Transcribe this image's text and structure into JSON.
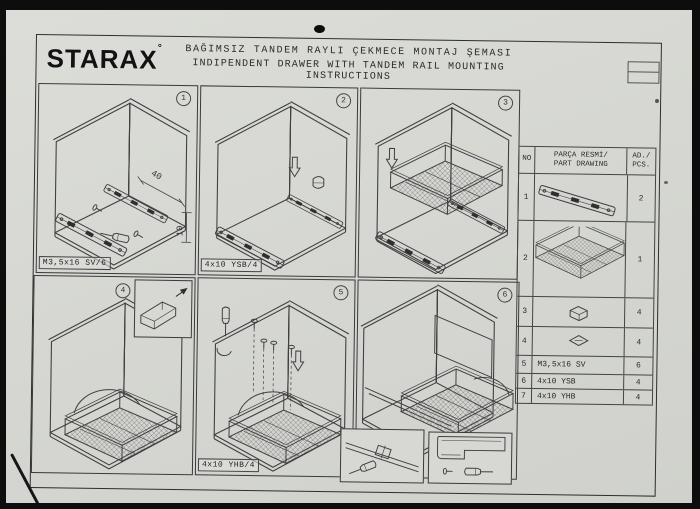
{
  "header": {
    "logo": "STARAX",
    "logo_mark": "°",
    "title_line1": "BAĞIMSIZ TANDEM RAYLI ÇEKMECE MONTAJ ŞEMASI",
    "title_line2": "INDIPENDENT DRAWER WITH TANDEM RAIL MOUNTING INSTRUCTIONS"
  },
  "panels": [
    {
      "number": "1",
      "label": "M3,5x16 SV/6",
      "dim_a": "40",
      "dim_b": "10"
    },
    {
      "number": "2",
      "label": "4x10 YSB/4"
    },
    {
      "number": "3"
    },
    {
      "number": "4"
    },
    {
      "number": "5",
      "label": "4x10 YHB/4"
    },
    {
      "number": "6"
    }
  ],
  "table": {
    "header_no": "NO",
    "header_part_1": "PARÇA RESMİ/",
    "header_part_2": "PART DRAWING",
    "header_qty_1": "AD./",
    "header_qty_2": "PCS.",
    "rows": [
      {
        "no": "1",
        "part": "tandem-rail-drawing",
        "qty": "2"
      },
      {
        "no": "2",
        "part": "wire-basket-drawing",
        "qty": "1"
      },
      {
        "no": "3",
        "part": "plastic-clip-drawing",
        "qty": "4"
      },
      {
        "no": "4",
        "part": "cover-cap-drawing",
        "qty": "4"
      },
      {
        "no": "5",
        "part": "M3,5x16 SV",
        "qty": "6"
      },
      {
        "no": "6",
        "part": "4x10 YSB",
        "qty": "4"
      },
      {
        "no": "7",
        "part": "4x10 YHB",
        "qty": "4"
      }
    ]
  },
  "colors": {
    "paper": "#d7d8d2",
    "ink": "#3f3f3f",
    "scan_edge": "#0d0d0d"
  }
}
